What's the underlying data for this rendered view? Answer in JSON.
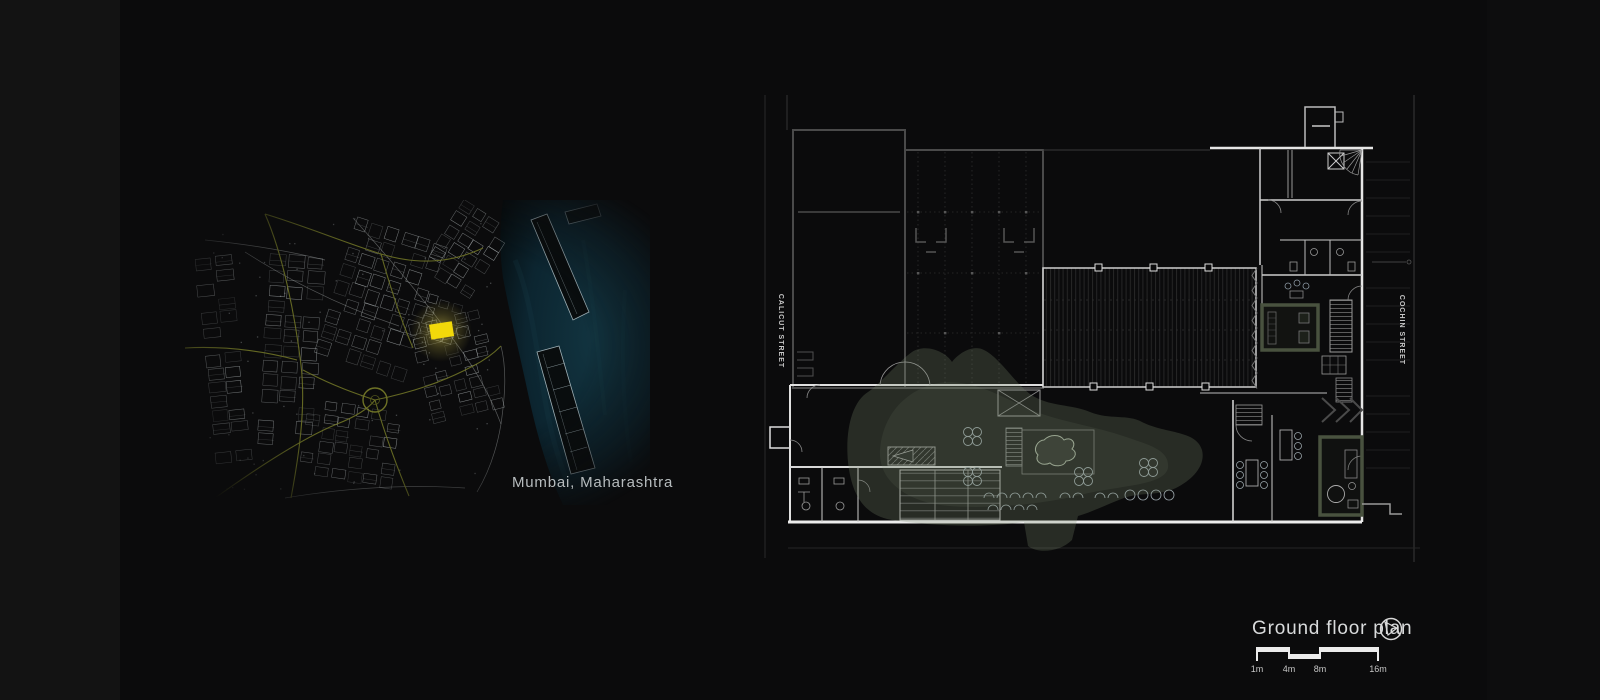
{
  "site_map": {
    "caption": "Mumbai, Maharashtra",
    "site_color": "#f2d90a",
    "water_color": "#113440",
    "road_color": "#6e7226",
    "street_color": "#cdd4d6"
  },
  "floor_plan": {
    "street_left_label": "CALICUT STREET",
    "street_right_label": "COCHIN STREET",
    "landscape_color": "#7d8b70",
    "wall_bright": "#e6e6e6",
    "wall_dim": "#4a4a4a"
  },
  "title_block": {
    "title": "Ground floor plan",
    "scale_labels": [
      "1m",
      "4m",
      "8m",
      "16m"
    ]
  }
}
